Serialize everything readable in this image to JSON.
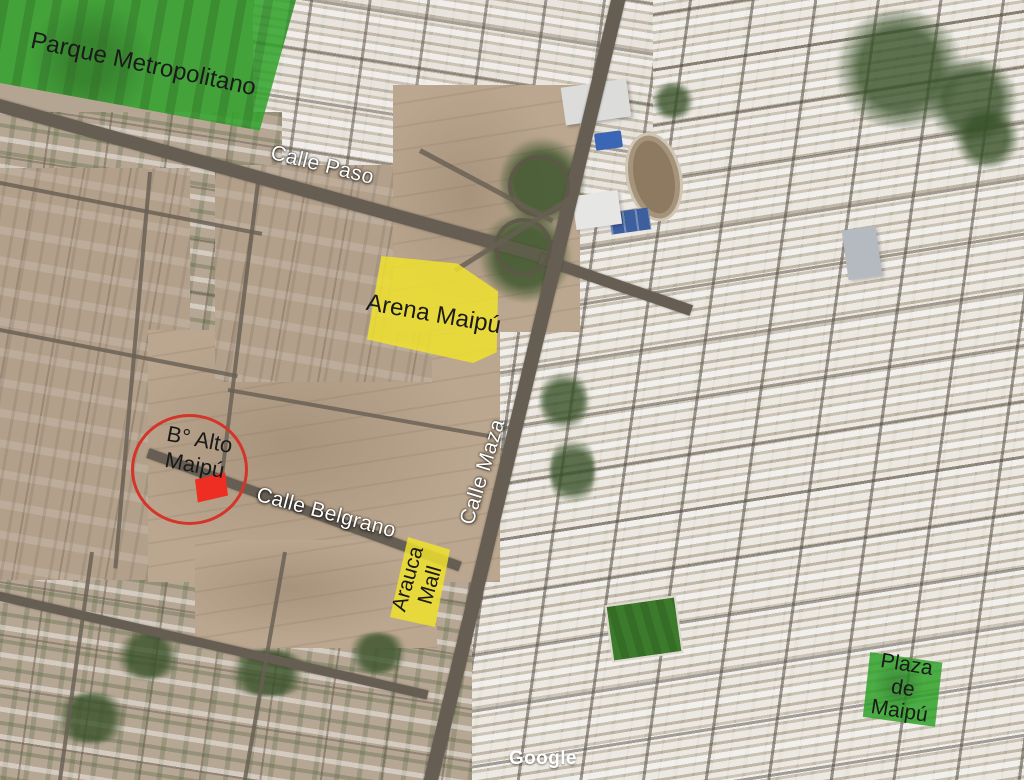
{
  "map": {
    "attribution_label": "Google",
    "road_labels": {
      "calle_paso": "Calle Paso",
      "calle_belgrano": "Calle Belgrano",
      "calle_maza": "Calle Maza"
    },
    "annotations": {
      "parque_metropolitano": {
        "label": "Parque Metropolitano",
        "fill": "#2fa32a"
      },
      "arena_maipu": {
        "label": "Arena Maipú",
        "fill": "#efe02e"
      },
      "alto_maipu": {
        "line1": "B° Alto",
        "line2": "Maipú",
        "circle_outline": "#d5342b",
        "marker_fill": "#ee2e22"
      },
      "arauca_mall": {
        "line1": "Arauca",
        "line2": "Mall",
        "fill": "#efe02e"
      },
      "plaza_de_maipu": {
        "line1": "Plaza",
        "line2": "de",
        "line3": "Maipú",
        "fill": "#2fa32a"
      }
    },
    "label_text_color": "#1a1a1a",
    "road_label_color": "#ffffff"
  }
}
